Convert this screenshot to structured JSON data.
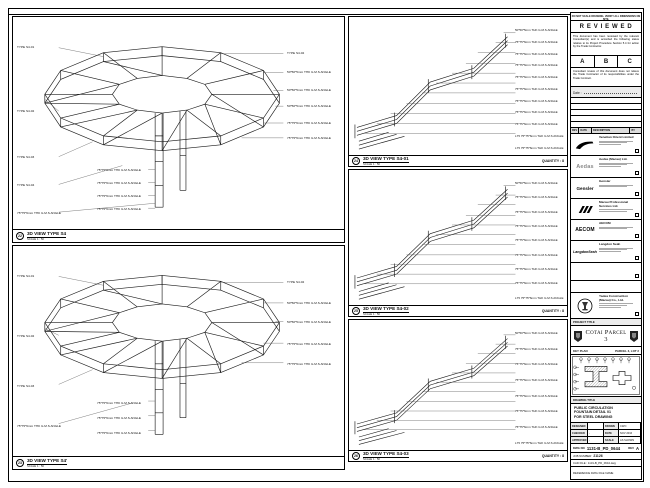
{
  "sheet_note": "DO NOT SCALE DRAWING. VERIFY ALL DIMENSIONS ON SITE.",
  "panels": {
    "a": {
      "marker": "22",
      "title": "3D VIEW TYPE S4",
      "scale": "SCALE 1 : 50",
      "left_labels": [
        "TYPE S4-01",
        "TYPE S4-02",
        "TYPE S4-03",
        "TYPE S4-04",
        "75*75*6mm THK G.M.S ANGLE"
      ],
      "right_labels": [
        "TYPE S4-02",
        "50*50*5mm THK G.M.S ANGLE",
        "50*50*5mm THK G.M.S ANGLE",
        "50*50*5mm THK G.M.S ANGLE",
        "75*75*6mm THK G.M.S ANGLE",
        "75*75*6mm THK G.M.S ANGLE"
      ],
      "bottom_labels": [
        "75*75*6mm THK G.M.S ANGLE",
        "75*75*6mm THK G.M.S ANGLE",
        "75*75*6mm THK G.M.S ANGLE",
        "75*75*6mm THK G.M.S ANGLE"
      ]
    },
    "b": {
      "marker": "23",
      "title": "3D VIEW TYPE S4'",
      "scale": "SCALE 1 : 50",
      "left_labels": [
        "TYPE S4-01",
        "TYPE S4-02",
        "TYPE S4-03",
        "75*75*6mm THK G.M.S ANGLE"
      ],
      "right_labels": [
        "TYPE S4-02",
        "50*50*5mm THK G.M.S ANGLE",
        "50*50*5mm THK G.M.S ANGLE",
        "75*75*6mm THK G.M.S ANGLE",
        "75*75*6mm THK G.M.S ANGLE"
      ],
      "bottom_labels": [
        "75*75*6mm THK G.M.S ANGLE",
        "75*75*6mm THK G.M.S ANGLE",
        "75*75*6mm THK G.M.S ANGLE"
      ]
    },
    "c": {
      "marker": "24",
      "title": "3D VIEW TYPE S4-01",
      "scale": "SCALE 1 : 50",
      "quantity": "QUANTITY : 8",
      "labels": [
        "50*50*5mm THK G.M.S ANGLE",
        "75*75*6mm THK G.M.S ANGLE",
        "75*75*6mm THK G.M.S ANGLE",
        "75*75*6mm THK G.M.S ANGLE",
        "75*75*6mm THK G.M.S ANGLE",
        "75*75*6mm THK G.M.S ANGLE",
        "75*75*6mm THK G.M.S ANGLE",
        "75*75*6mm THK G.M.S ANGLE",
        "75*75*6mm THK G.M.S ANGLE",
        "L75 75*75*6mm THK G.M.S ANGLE",
        "L75 75*75*6mm THK G.M.S ANGLE"
      ]
    },
    "d": {
      "marker": "25",
      "title": "3D VIEW TYPE S4-02",
      "scale": "SCALE 1 : 50",
      "quantity": "QUANTITY : 8",
      "labels": [
        "50*50*5mm THK G.M.S ANGLE",
        "75*75*6mm THK G.M.S ANGLE",
        "75*75*6mm THK G.M.S ANGLE",
        "75*75*6mm THK G.M.S ANGLE",
        "75*75*6mm THK G.M.S ANGLE",
        "75*75*6mm THK G.M.S ANGLE",
        "75*75*6mm THK G.M.S ANGLE",
        "75*75*6mm THK G.M.S ANGLE",
        "L75 75*75*6mm THK G.M.S ANGLE"
      ]
    },
    "e": {
      "marker": "26",
      "title": "3D VIEW TYPE S4-03",
      "scale": "SCALE 1 : 50",
      "quantity": "QUANTITY : 8",
      "labels": [
        "50*50*5mm THK G.M.S ANGLE",
        "75*75*6mm THK G.M.S ANGLE",
        "75*75*6mm THK G.M.S ANGLE",
        "75*75*6mm THK G.M.S ANGLE",
        "75*75*6mm THK G.M.S ANGLE",
        "75*75*6mm THK G.M.S ANGLE",
        "75*75*6mm THK G.M.S ANGLE",
        "L75 75*75*6mm THK G.M.S ANGLE"
      ]
    }
  },
  "stamp": {
    "title": "R E V I E W E D",
    "para1": "This document has been reviewed by the relevant Consultant(s) and is accorded the following status relative to its Project Procedure Section 5.4 for action by the Trade Contractor.",
    "grades": [
      "A",
      "B",
      "C"
    ],
    "para2": "Consultant review of this document does not relieve the Trade Contractor of its responsibilities under the Trade Contract.",
    "date_label": "Date :"
  },
  "rev_table": {
    "headers": [
      "REV",
      "DATE",
      "DESCRIPTION",
      "BY"
    ]
  },
  "companies": {
    "venetian": {
      "name": "Venetian Orient Limited"
    },
    "aedas": {
      "logo": "Aedas",
      "name": "Aedas (Macau) Ltd."
    },
    "gensler": {
      "logo": "Gensler",
      "name": "Gensler"
    },
    "mps": {
      "name": "Macau Professional Services Ltd."
    },
    "aecom": {
      "logo": "AECOM",
      "name": "AECOM"
    },
    "langdon": {
      "logo": "LangdonSeah",
      "name": "Langdon Seah"
    }
  },
  "contractor": {
    "name": "Yadea Construction (Macau) Co., Ltd."
  },
  "project": {
    "label": "PROJECT TITLE",
    "title": "Cotai Parcel 3"
  },
  "keyplan": {
    "label": "KEY PLAN",
    "ref": "PARCEL 3, LOT 2"
  },
  "drawing": {
    "label": "DRAWING TITLE",
    "lines": [
      "PUBLIC CIRCULATION",
      "FOUNTAIN DETAIL 01",
      "FOR STEEL DRAWING"
    ]
  },
  "signoff": {
    "rows": [
      [
        "DESIGNED",
        "",
        "DRAWN",
        "CWO"
      ],
      [
        "CHECKED",
        "-",
        "DATE",
        "NOV 2016"
      ],
      [
        "APPROVED",
        "-",
        "SCALE",
        "AS SHOWN"
      ]
    ]
  },
  "dwg": {
    "label": "DWG NO",
    "no": "1131-B_PD_0644",
    "rev_label": "REV",
    "rev": "A"
  },
  "job": {
    "label": "JOB NUMBER",
    "no": "21126"
  },
  "cad_file": "CAD FILE : 1131-B_PD_0644.dwg",
  "ref_note": "REFERENCE DWG FILE NAME"
}
